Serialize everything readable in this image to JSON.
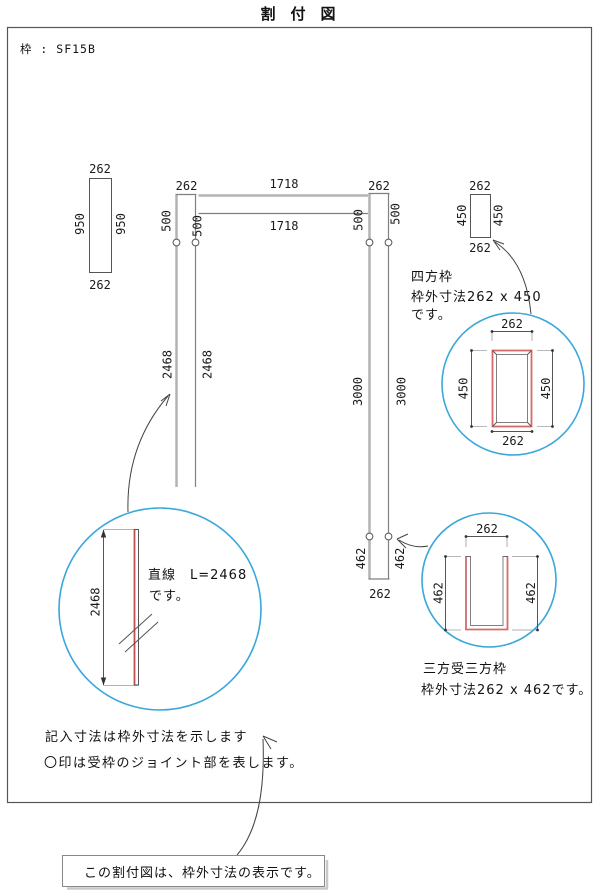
{
  "title": "割　付　図",
  "frame_spec": {
    "label": "枠 : SF15B"
  },
  "colors": {
    "circle_blue": "#3aa7db",
    "frame_red": "#d66a6a",
    "member_gray": "#b3b3b3"
  },
  "bar_950": {
    "top_width": "262",
    "left_length": "950",
    "right_length": "950",
    "bottom_width": "262"
  },
  "layout": {
    "left_member": {
      "width": "262",
      "joint_offset_outer": "500",
      "joint_offset_inner": "500",
      "length_outer": "2468",
      "length_inner": "2468"
    },
    "top_rail": {
      "span_outer": "1718",
      "span_inner": "1718"
    },
    "right_member": {
      "width": "262",
      "joint_offset_outer": "500",
      "joint_offset_inner": "500",
      "length_outer": "3000",
      "length_inner": "3000",
      "bottom_joint_offset_outer": "462",
      "bottom_joint_offset_inner": "462",
      "bottom_width": "262"
    }
  },
  "shiho_waku": {
    "symbol": {
      "top_width": "262",
      "left_height": "450",
      "right_height": "450",
      "bottom_width": "262"
    },
    "caption_line1": "四方枠",
    "caption_line2": "枠外寸法262 x 450",
    "caption_line3": "です。",
    "detail": {
      "top_width": "262",
      "left_height": "450",
      "right_height": "450",
      "bottom_width": "262"
    }
  },
  "straight_piece": {
    "dim": "2468",
    "caption_line1": "直線　L=2468",
    "caption_line2": "です。"
  },
  "sanpo_waku": {
    "detail": {
      "top_width": "262",
      "left_height": "462",
      "right_height": "462"
    },
    "caption_line1": "三方受三方枠",
    "caption_line2": "枠外寸法262 x 462です。"
  },
  "notes": {
    "line1": "記入寸法は枠外寸法を示します",
    "line2": "〇印は受枠のジョイント部を表します。"
  },
  "footer_note": {
    "text": "この割付図は、枠外寸法の表示です。"
  }
}
